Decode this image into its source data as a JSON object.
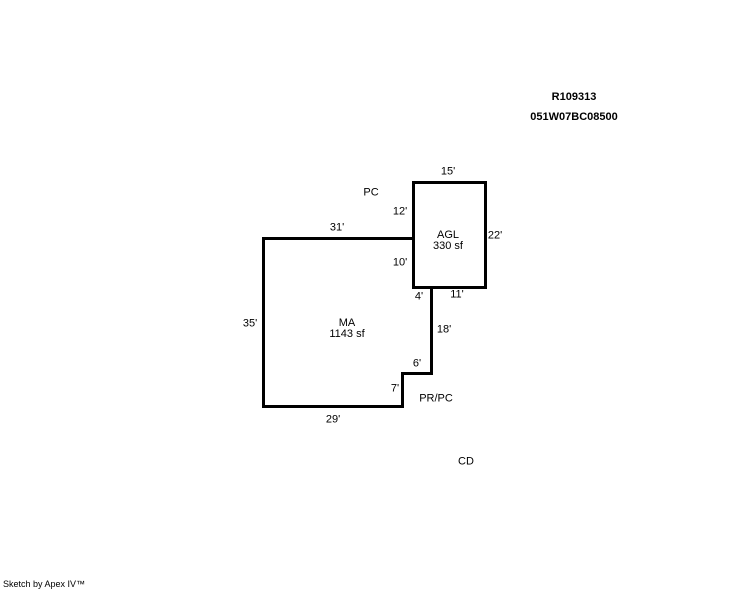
{
  "header": {
    "record_id": "R109313",
    "parcel_number": "051W07BC08500"
  },
  "sketch": {
    "areas": {
      "agl": {
        "name": "AGL",
        "size": "330 sf"
      },
      "ma": {
        "name": "MA",
        "size": "1143 sf"
      }
    },
    "zone_labels": {
      "pc": "PC",
      "pr_pc": "PR/PC",
      "cd": "CD"
    },
    "dimensions": {
      "agl_top": "15'",
      "agl_left_upper": "12'",
      "agl_left_lower": "10'",
      "agl_right": "22'",
      "agl_bottom": "11'",
      "ma_top": "31'",
      "ma_left": "35'",
      "ma_bottom": "29'",
      "step_right": "4'",
      "step_down": "18'",
      "notch_top": "6'",
      "notch_side": "7'"
    }
  },
  "footer": {
    "credit": "Sketch by Apex IV™"
  },
  "colors": {
    "line": "#000000",
    "background": "#ffffff",
    "text": "#000000"
  }
}
